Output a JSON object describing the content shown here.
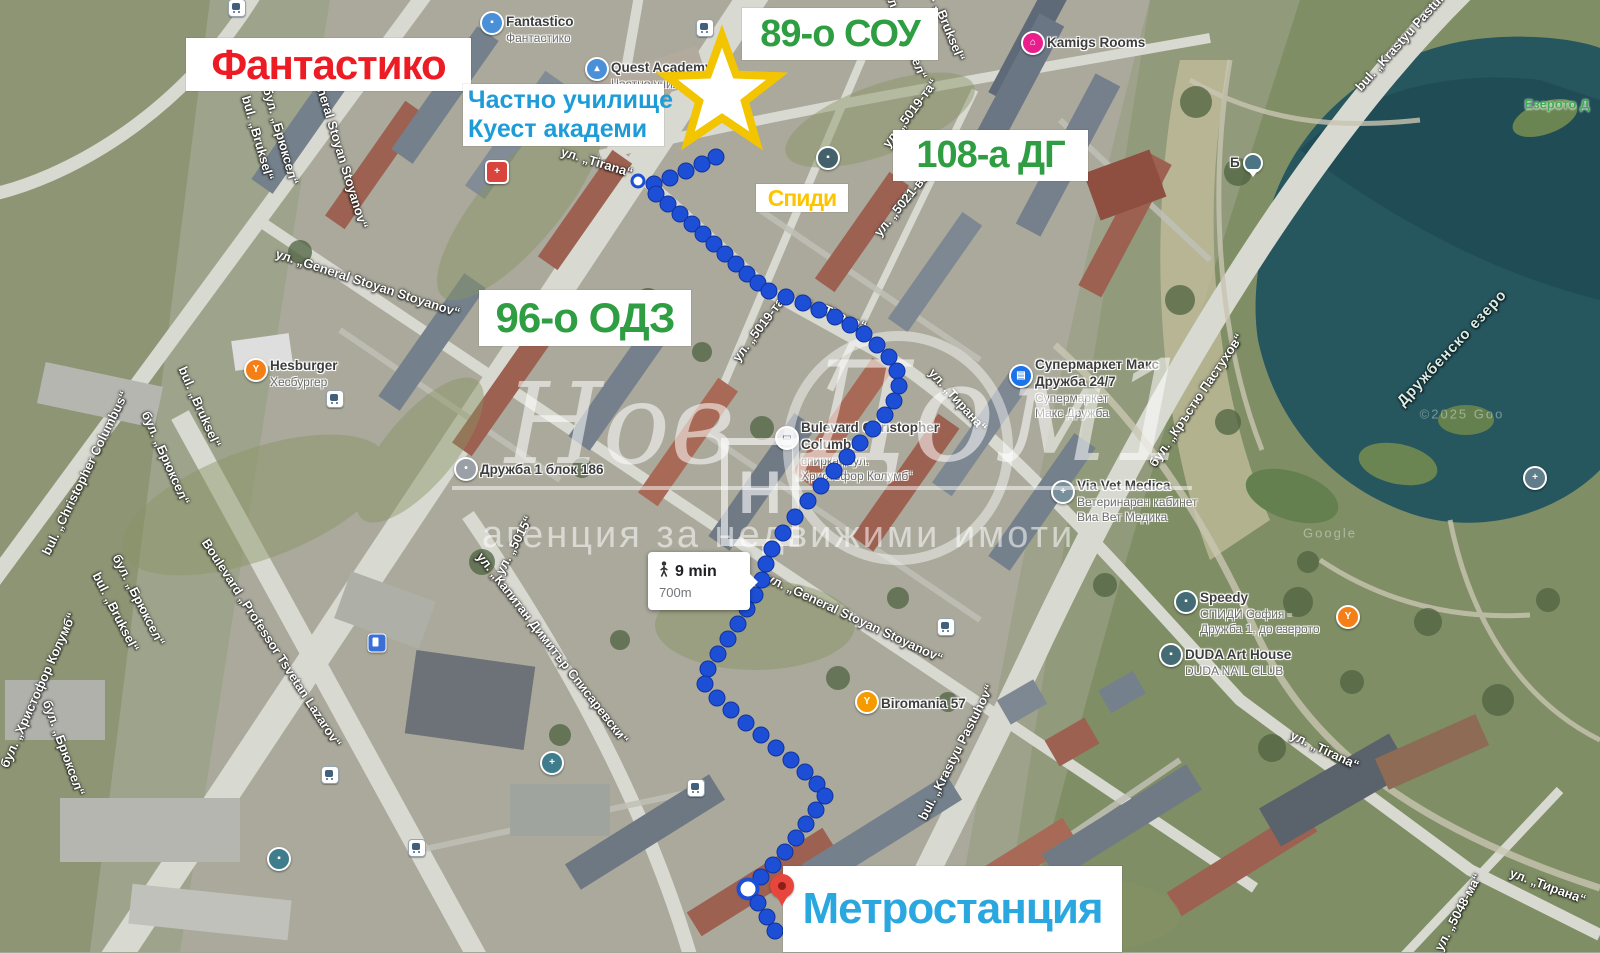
{
  "annotations": {
    "store": "Фантастико",
    "school89": "89-о СОУ",
    "private_school_line1": "Частно училище",
    "private_school_line2": "Куест академи",
    "kindergarten108": "108-а ДГ",
    "speedy": "Спиди",
    "kindergarten96": "96-о ОДЗ",
    "metro": "Метростанция"
  },
  "watermark": {
    "word1": "Нов",
    "word2": "Дом1",
    "logo_letter": "Н",
    "subtitle": "агенция за недвижими имоти"
  },
  "route": {
    "duration": "9 min",
    "distance": "700m",
    "small_index": 0,
    "ring_index": 62,
    "dots": [
      [
        638,
        181
      ],
      [
        654,
        184
      ],
      [
        670,
        178
      ],
      [
        686,
        171
      ],
      [
        702,
        164
      ],
      [
        716,
        157
      ],
      [
        656,
        194
      ],
      [
        668,
        204
      ],
      [
        680,
        214
      ],
      [
        692,
        224
      ],
      [
        703,
        234
      ],
      [
        714,
        244
      ],
      [
        725,
        254
      ],
      [
        736,
        264
      ],
      [
        747,
        274
      ],
      [
        758,
        283
      ],
      [
        769,
        291
      ],
      [
        786,
        297
      ],
      [
        803,
        303
      ],
      [
        819,
        310
      ],
      [
        835,
        317
      ],
      [
        850,
        325
      ],
      [
        864,
        334
      ],
      [
        877,
        345
      ],
      [
        889,
        357
      ],
      [
        897,
        371
      ],
      [
        899,
        386
      ],
      [
        894,
        401
      ],
      [
        885,
        415
      ],
      [
        873,
        429
      ],
      [
        860,
        443
      ],
      [
        847,
        457
      ],
      [
        834,
        471
      ],
      [
        821,
        486
      ],
      [
        808,
        501
      ],
      [
        795,
        517
      ],
      [
        783,
        533
      ],
      [
        772,
        549
      ],
      [
        766,
        564
      ],
      [
        762,
        580
      ],
      [
        755,
        595
      ],
      [
        747,
        609
      ],
      [
        738,
        624
      ],
      [
        728,
        639
      ],
      [
        718,
        654
      ],
      [
        708,
        669
      ],
      [
        705,
        684
      ],
      [
        717,
        698
      ],
      [
        731,
        710
      ],
      [
        746,
        723
      ],
      [
        761,
        735
      ],
      [
        776,
        748
      ],
      [
        791,
        760
      ],
      [
        805,
        772
      ],
      [
        817,
        784
      ],
      [
        825,
        796
      ],
      [
        816,
        810
      ],
      [
        806,
        824
      ],
      [
        796,
        838
      ],
      [
        785,
        852
      ],
      [
        773,
        865
      ],
      [
        761,
        877
      ],
      [
        748,
        889
      ],
      [
        758,
        903
      ],
      [
        767,
        917
      ],
      [
        775,
        931
      ]
    ]
  },
  "b_pin_label": "Б",
  "pois": [
    {
      "name": "pharmacy-nota-bene",
      "x": 497,
      "y": 172,
      "side": "left",
      "dy": -22,
      "bg": "#d9453c",
      "shape": "square",
      "glyph": "+",
      "lines": [
        {
          "t": "Денонощна аптека „",
          "s": "b"
        },
        {
          "t": "Нота Бене“ Дружба 1",
          "s": "b"
        }
      ]
    },
    {
      "name": "fantastico-store",
      "x": 492,
      "y": 23,
      "side": "right",
      "dy": -9,
      "bg": "#4a90d9",
      "shape": "round",
      "glyph": "▪",
      "lines": [
        {
          "t": "Fantastico",
          "s": "b"
        },
        {
          "t": "Фантастико",
          "s": "g"
        }
      ]
    },
    {
      "name": "quest-academy",
      "x": 597,
      "y": 69,
      "side": "right",
      "dy": -9,
      "bg": "#4a90d9",
      "shape": "round",
      "glyph": "▴",
      "lines": [
        {
          "t": "Quest Academy",
          "s": "b"
        },
        {
          "t": "Частно училище Куест",
          "s": "g"
        }
      ]
    },
    {
      "name": "speedy-druzhba-186",
      "x": 828,
      "y": 158,
      "side": "left",
      "dy": -15,
      "bg": "#44616b",
      "shape": "round",
      "glyph": "▪",
      "lines": [
        {
          "t": "Speedy",
          "s": "b"
        },
        {
          "t": "СПИДИ СОФИЯ -",
          "s": "g"
        },
        {
          "t": "ДРУЖБА 1, БЛ. 186",
          "s": "g"
        }
      ]
    },
    {
      "name": "kamigs-rooms",
      "x": 1033,
      "y": 43,
      "side": "right",
      "dy": -8,
      "bg": "#e91e8c",
      "shape": "round",
      "glyph": "⌂",
      "lines": [
        {
          "t": "Kamigs Rooms",
          "s": "b"
        }
      ]
    },
    {
      "name": "hesburger",
      "x": 256,
      "y": 370,
      "side": "right",
      "dy": -12,
      "bg": "#f57f17",
      "shape": "round",
      "glyph": "Y",
      "lines": [
        {
          "t": "Hesburger",
          "s": "b"
        },
        {
          "t": "Хесбургер",
          "s": "g"
        }
      ]
    },
    {
      "name": "druzhba-blok-186",
      "x": 466,
      "y": 469,
      "side": "right",
      "dy": -7,
      "bg": "#9aa0a6",
      "shape": "round",
      "glyph": "•",
      "lines": [
        {
          "t": "Дружба 1 блок 186",
          "s": "b"
        }
      ]
    },
    {
      "name": "supermarket-maks",
      "x": 1021,
      "y": 376,
      "side": "right",
      "dy": -19,
      "bg": "#1a73e8",
      "shape": "round",
      "glyph": "▤",
      "lines": [
        {
          "t": "Супермаркет Макс",
          "s": "b"
        },
        {
          "t": "Дружба 24/7",
          "s": "b"
        },
        {
          "t": "Супермаркет",
          "s": "g"
        },
        {
          "t": "Макс Дружба",
          "s": "g"
        }
      ]
    },
    {
      "name": "bus-stop-columbus",
      "x": 787,
      "y": 438,
      "side": "right",
      "dy": -18,
      "bg": "#e8eaed",
      "shape": "round",
      "glyph": "▭",
      "glyph_color": "#5f6a72",
      "lines": [
        {
          "t": "Bulevard Christopher",
          "s": "b"
        },
        {
          "t": "Columbus",
          "s": "b"
        },
        {
          "t": "спирка „бул.",
          "s": "g"
        },
        {
          "t": "Христофор Колумб“",
          "s": "g"
        }
      ]
    },
    {
      "name": "via-vet-medica",
      "x": 1063,
      "y": 492,
      "side": "right",
      "dy": -14,
      "bg": "#78909c",
      "shape": "round",
      "glyph": "+",
      "lines": [
        {
          "t": "Via Vet Medica",
          "s": "b"
        },
        {
          "t": "Ветеринарен кабинет",
          "s": "g"
        },
        {
          "t": "Виа Вет Медика",
          "s": "g"
        }
      ]
    },
    {
      "name": "speedy-do-ezeroto",
      "x": 1186,
      "y": 602,
      "side": "right",
      "dy": -12,
      "bg": "#456b75",
      "shape": "round",
      "glyph": "▪",
      "lines": [
        {
          "t": "Speedy",
          "s": "b"
        },
        {
          "t": "СПИДИ София -",
          "s": "g"
        },
        {
          "t": "Дружба 1, до езерото",
          "s": "g"
        }
      ]
    },
    {
      "name": "lake-restaurant",
      "x": 1348,
      "y": 617,
      "side": "right",
      "dy": -8,
      "bg": "#f57f17",
      "shape": "round",
      "glyph": "Y",
      "lines": []
    },
    {
      "name": "duda-art-house",
      "x": 1171,
      "y": 655,
      "side": "right",
      "dy": -8,
      "bg": "#456b75",
      "shape": "round",
      "glyph": "▪",
      "lines": [
        {
          "t": "DUDA Art House",
          "s": "b"
        },
        {
          "t": "DUDA NAIL CLUB",
          "s": "g"
        }
      ]
    },
    {
      "name": "biromania-57",
      "x": 867,
      "y": 702,
      "side": "right",
      "dy": -6,
      "bg": "#f59b00",
      "shape": "round",
      "glyph": "Y",
      "lines": [
        {
          "t": "Biromania 57",
          "s": "b"
        }
      ]
    },
    {
      "name": "smdl-ramus",
      "x": 552,
      "y": 763,
      "side": "left",
      "dy": -8,
      "bg": "#3f7d8c",
      "shape": "round",
      "glyph": "+",
      "lines": [
        {
          "t": "СМДЛ Рамус ООД",
          "s": "b"
        }
      ]
    },
    {
      "name": "bosch-service",
      "x": 279,
      "y": 859,
      "side": "left",
      "dy": -24,
      "bg": "#3f7d8c",
      "shape": "round",
      "glyph": "▪",
      "lines": [
        {
          "t": "BOSCH SERVICE",
          "s": "b"
        },
        {
          "t": "Valpe Sofia",
          "s": "b"
        },
        {
          "t": "Автосервиз „Bosch“",
          "s": "g"
        }
      ]
    },
    {
      "name": "chapel-introduction-virgin",
      "x": 1535,
      "y": 478,
      "side": "left",
      "dy": -26,
      "bg": "#607d8b",
      "shape": "round",
      "glyph": "+",
      "lines": [
        {
          "t": "Chapel \"Introduction",
          "s": "w"
        },
        {
          "t": "of the Virgin\"",
          "s": "w"
        },
        {
          "t": "Храм „Въведение",
          "s": "wg"
        },
        {
          "t": "Богородично“",
          "s": "wg"
        }
      ]
    }
  ],
  "streets": [
    {
      "t": "бул. „Брюксел“",
      "x": 905,
      "y": 32,
      "r": 68
    },
    {
      "t": "bul. „Bruksel“",
      "x": 945,
      "y": 20,
      "r": 68
    },
    {
      "t": "bul. „Bruksel“",
      "x": 258,
      "y": 138,
      "r": 74
    },
    {
      "t": "бул. „Брюксел“",
      "x": 281,
      "y": 136,
      "r": 74
    },
    {
      "t": "bul. „Bruksel“",
      "x": 200,
      "y": 407,
      "r": 66
    },
    {
      "t": "бул. „Брюксел“",
      "x": 166,
      "y": 458,
      "r": 66
    },
    {
      "t": "bul. „Bruksel“",
      "x": 116,
      "y": 612,
      "r": 63
    },
    {
      "t": "бул. „Брюксел“",
      "x": 139,
      "y": 600,
      "r": 63
    },
    {
      "t": "бул. „Брюксел“",
      "x": 64,
      "y": 748,
      "r": 70
    },
    {
      "t": "bul. „Christopher Columbus“",
      "x": 85,
      "y": 473,
      "r": -64
    },
    {
      "t": "бул. „Христофор Колумб“",
      "x": 38,
      "y": 690,
      "r": -66
    },
    {
      "t": "Boulevard „Professor Tsvetan Lazarov“",
      "x": 272,
      "y": 643,
      "r": 57
    },
    {
      "t": "ул. „Капитан Димитър Списаревски“",
      "x": 553,
      "y": 648,
      "r": 52
    },
    {
      "t": "ул. „5015“",
      "x": 514,
      "y": 545,
      "r": -62
    },
    {
      "t": "ул. „General Stoyan Stoyanov“",
      "x": 368,
      "y": 283,
      "r": 18
    },
    {
      "t": "ул. „General Stoyan Stoyanov“",
      "x": 336,
      "y": 136,
      "r": 73
    },
    {
      "t": "ул. „General Stoyan Stoyanov“",
      "x": 855,
      "y": 618,
      "r": 25
    },
    {
      "t": "ул. „Tirana“",
      "x": 597,
      "y": 162,
      "r": 17
    },
    {
      "t": "ул. „Tirana“",
      "x": 832,
      "y": 312,
      "r": 23
    },
    {
      "t": "ул. „Тирана“",
      "x": 958,
      "y": 400,
      "r": 48
    },
    {
      "t": "ул. „Tirana“",
      "x": 1325,
      "y": 750,
      "r": 25
    },
    {
      "t": "ул. „Тирана“",
      "x": 1548,
      "y": 886,
      "r": 20
    },
    {
      "t": "ул. „5048-ма“",
      "x": 1458,
      "y": 912,
      "r": -62
    },
    {
      "t": "ул. „5019-та“",
      "x": 910,
      "y": 113,
      "r": -53
    },
    {
      "t": "ул. „5021-ва“",
      "x": 903,
      "y": 202,
      "r": -51
    },
    {
      "t": "ул. „5019-та“",
      "x": 760,
      "y": 327,
      "r": -53
    },
    {
      "t": "bul. „Krastyu Pastuhov“",
      "x": 1408,
      "y": 33,
      "r": -48
    },
    {
      "t": "бул. „Кръстю Пастухов“",
      "x": 1196,
      "y": 400,
      "r": -56
    },
    {
      "t": "bul. „Krastyu Pastuhov“",
      "x": 956,
      "y": 752,
      "r": -63
    },
    {
      "t": "Дружбенско езеро",
      "x": 1452,
      "y": 348,
      "r": -47,
      "cls": "lake"
    },
    {
      "t": "Езерото Д",
      "x": 1557,
      "y": 104,
      "r": 0,
      "cls": "park"
    },
    {
      "t": "Google",
      "x": 1330,
      "y": 533,
      "r": 0,
      "cls": "faint"
    },
    {
      "t": "©2025 Goo",
      "x": 1462,
      "y": 414,
      "r": 0,
      "cls": "faint"
    }
  ],
  "transit_icons": [
    [
      237,
      8
    ],
    [
      705,
      28
    ],
    [
      335,
      399
    ],
    [
      946,
      627
    ],
    [
      330,
      775
    ],
    [
      696,
      788
    ],
    [
      417,
      848
    ]
  ],
  "fuel_icon": [
    377,
    643
  ]
}
